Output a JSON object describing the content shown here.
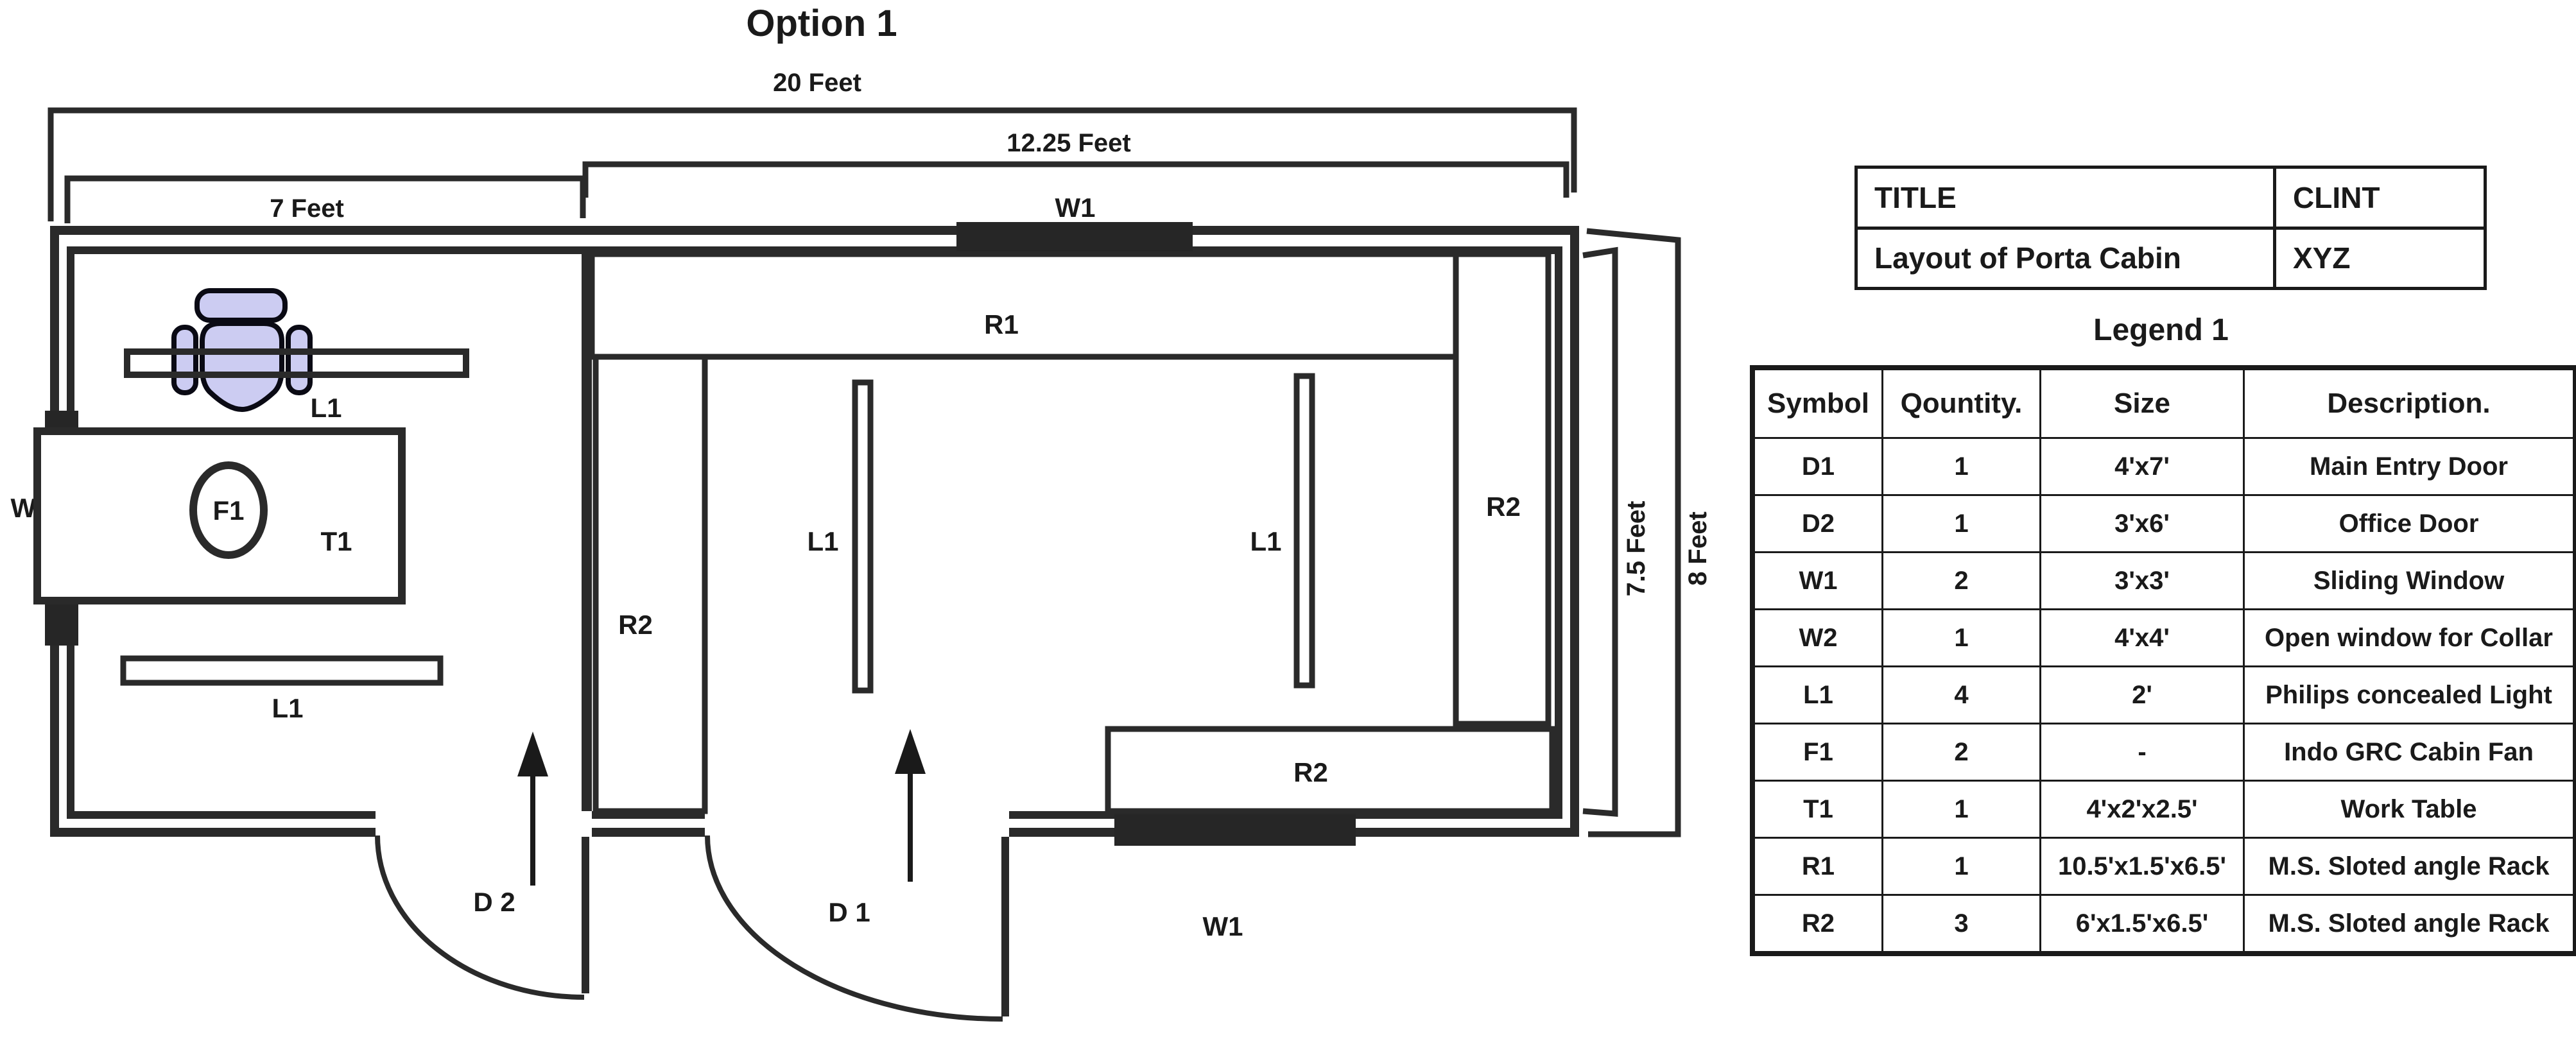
{
  "title": "Option 1",
  "colors": {
    "line": "#2a2a2a",
    "text": "#1a1a1a",
    "chair_fill": "#ccccf2",
    "window_fill": "#262626",
    "background": "#ffffff"
  },
  "dimensions": {
    "overall_width": "20 Feet",
    "main_room_width": "12.25  Feet",
    "office_width": "7 Feet",
    "inner_height": "7.5 Feet",
    "outer_height": "8 Feet"
  },
  "plan": {
    "r1": "R1",
    "r2": "R2",
    "l1": "L1",
    "t1": "T1",
    "f1": "F1",
    "w1": "W1",
    "w2": "W2",
    "d1": "D 1",
    "d2": "D 2"
  },
  "title_block": {
    "rows": [
      [
        "TITLE",
        "CLINT"
      ],
      [
        "Layout of  Porta Cabin",
        "XYZ"
      ]
    ]
  },
  "legend": {
    "title": "Legend 1",
    "headers": [
      "Symbol",
      "Qountity.",
      "Size",
      "Description."
    ],
    "rows": [
      [
        "D1",
        "1",
        "4'x7'",
        "Main Entry Door"
      ],
      [
        "D2",
        "1",
        "3'x6'",
        "Office Door"
      ],
      [
        "W1",
        "2",
        "3'x3'",
        "Sliding Window"
      ],
      [
        "W2",
        "1",
        "4'x4'",
        "Open window for Collar"
      ],
      [
        "L1",
        "4",
        "2'",
        "Philips concealed  Light"
      ],
      [
        "F1",
        "2",
        "-",
        "Indo GRC Cabin Fan"
      ],
      [
        "T1",
        "1",
        "4'x2'x2.5'",
        "Work Table"
      ],
      [
        "R1",
        "1",
        "10.5'x1.5'x6.5'",
        "M.S. Sloted angle Rack"
      ],
      [
        "R2",
        "3",
        "6'x1.5'x6.5'",
        "M.S. Sloted angle Rack"
      ]
    ]
  }
}
